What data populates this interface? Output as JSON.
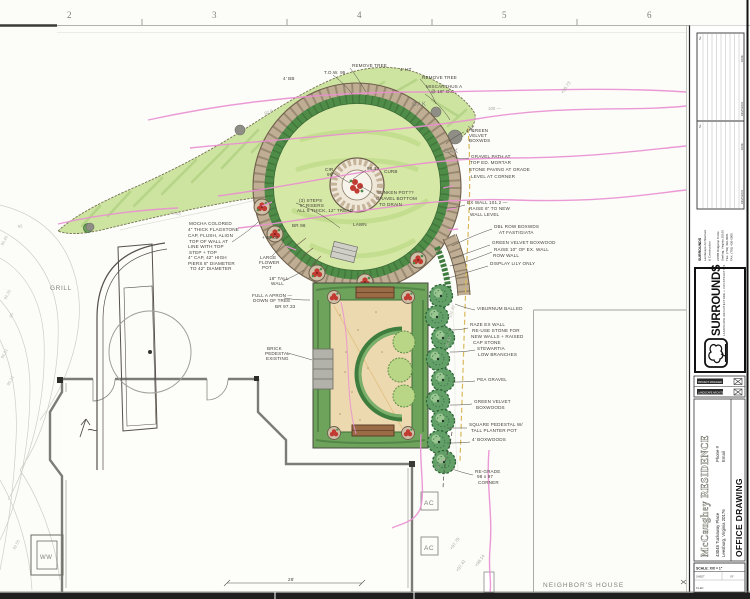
{
  "ruler": [
    "2",
    "3",
    "4",
    "5",
    "6"
  ],
  "labels": {
    "grill": "GRILL",
    "window_well": "WW",
    "ac": "AC",
    "neighbors_house": "NEIGHBOR'S HOUSE",
    "oak": "OAK",
    "dimension": "26'"
  },
  "contour_labels": [
    "93",
    "94.40",
    "94.35",
    "95",
    "94.01",
    "95.21",
    "92.55",
    "101.32",
    "97.92",
    "98.93"
  ],
  "spot_elevations": [
    "+97.79",
    "+97.41",
    "+98.14",
    "+97.60",
    "+99.73",
    "100 —",
    "92.0"
  ],
  "notes": [
    "REMOVE TREE",
    "T.O.W. 95",
    "4' HT",
    "REMOVE TREE",
    "MISCANTHUS A",
    "@ 18\" O.C.",
    "4' BB",
    "4' GREEN",
    "VELVET",
    "BOXWDS",
    "GRAVEL PATH AT",
    "TOP ED. MORTAR",
    "STONE PAVING AT GRADE",
    "LEVEL AT CORNER",
    "EX WALL 101.2 —",
    "RAISE 6\" TO NEW",
    "WALL LEVEL",
    "DBL ROW BOXWDS",
    "AT FASTIGIATA",
    "GREEN VELVET BOXWOOD",
    "RAISE 10\" OF EX. WALL",
    "ROW WALL",
    "DISPLAY LILY ONLY",
    "VIBURNUM BALLED",
    "RAZE EX WALL",
    "RE-USE STONE FOR",
    "NEW WALLS + RAISED",
    "CAP STONE",
    "STEWARTIA",
    "LOW BRANCHES",
    "PEA GRAVEL",
    "GREEN VELVET",
    "BOXWOODS",
    "SQUARE PEDESTAL W/",
    "TALL PLANTER POT",
    "4' BOXWOODS",
    "RE-GRADE",
    "98 x 97",
    "CORNER",
    "MOCHA COLORED",
    "4\" THICK FLAGSTONE",
    "CAP, FLUSH, ALIGN",
    "TOP OF WALL AT",
    "LINE WITH TOP",
    "STEP + TOP",
    "4\" CAP, 42\" HIGH",
    "PIERS 8\" DIAMETER",
    "TO 42\" DIAMETER",
    "(3) STEPS",
    "6\" RISERS",
    "ALL 5 THICK, 12\" TREAD",
    "CIR",
    "96",
    "96.13",
    "CURB",
    "SUNKEN POT??",
    "GRAVEL BOTTOM",
    "TO DRAIN",
    "LAWN",
    "BR 98",
    "+ 98.02",
    "18\" TALL",
    "WALL",
    "LARGE",
    "FLOWER",
    "POT",
    "FULL A APRON —",
    "DOWN OF TREE",
    "BR 97.33",
    "BRICK",
    "PEDESTAL",
    "EXISTING"
  ],
  "titleblock": {
    "revisions": {
      "date": "DATE",
      "revisions": "REVISIONS",
      "no": "No."
    },
    "firm": {
      "name": "SURROUNDS",
      "line1": "Landscape Architecture",
      "line2": "& Construction",
      "address1": "21585 Ridgetop Circle",
      "address2": "Sterling, Virginia 20166",
      "tel": "TEL: (703) 430-6001",
      "fax": "FAX: (703) 430-6005"
    },
    "logo": {
      "wordmark": "SURROUNDS",
      "tagline": "LANDSCAPE ARCHITECTURE + CONSTRUCTION"
    },
    "roles": {
      "pm": "PROJECT MANAGER",
      "la": "LANDSCAPE ARCHITECT"
    },
    "project": {
      "name": "McCaughey RESIDENCE",
      "address1": "43048 Tuckaway Place",
      "address2": "Leesburg, Virginia 20176",
      "phone": "Phone #",
      "email": "Email",
      "drawing_title": "OFFICE DRAWING"
    },
    "scale": {
      "scale": "SCALE: X/X = 1\"",
      "sheet": "SHEET",
      "of": "OF",
      "filed": "FILED"
    }
  },
  "colors": {
    "pink_grading": "#ea8fd2",
    "bed_green": "#cde3a0",
    "hedge_green": "#4e8c48",
    "lawn_green": "#d6e8a6",
    "stone_tan": "#bfae94",
    "patio_tan": "#ecd9b0",
    "bench_brown": "#9b6b45",
    "flower_red": "#c23b32",
    "conifer_green": "#63a068"
  }
}
